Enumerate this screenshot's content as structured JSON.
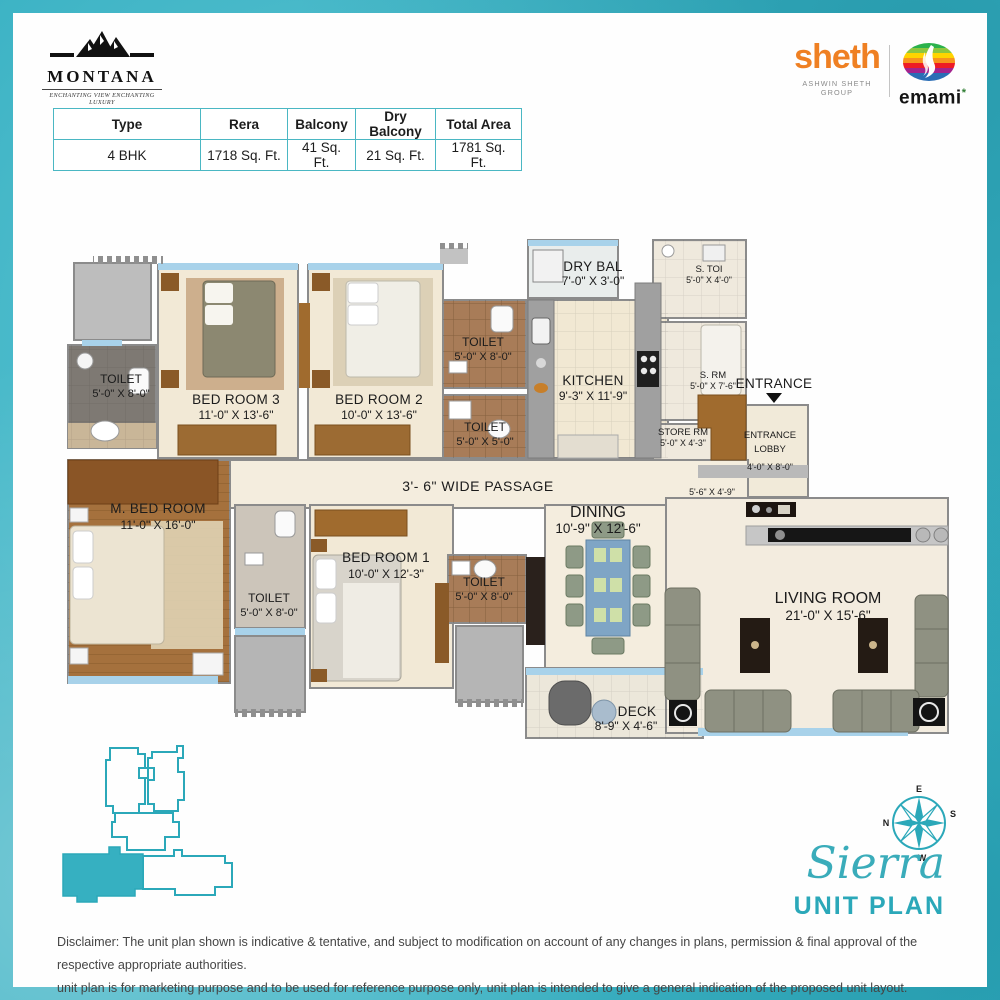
{
  "header": {
    "montana": {
      "name": "MONTANA",
      "tagline": "ENCHANTING VIEW ENCHANTING LUXURY"
    },
    "sheth": {
      "name": "sheth",
      "subtitle": "ASHWIN SHETH GROUP",
      "color": "#ef8023"
    },
    "emami": {
      "name": "emami",
      "mark": "*"
    }
  },
  "spec_table": {
    "headers": [
      "Type",
      "Rera",
      "Balcony",
      "Dry Balcony",
      "Total Area"
    ],
    "row": [
      "4 BHK",
      "1718 Sq. Ft.",
      "41 Sq. Ft.",
      "21 Sq. Ft.",
      "1781 Sq. Ft."
    ]
  },
  "plan": {
    "passage_label": "3'- 6\" WIDE PASSAGE",
    "entrance_label": "ENTRANCE",
    "lobby": {
      "line1": "ENTRANCE",
      "line2": "LOBBY",
      "dims": "4'-0\" X 8'-0\""
    },
    "lobby_passage_dims": "5'-6\" X 4'-9\"",
    "rooms": [
      {
        "name": "TOILET",
        "dims": "5'-0\" X 8'-0\""
      },
      {
        "name": "BED ROOM 3",
        "dims": "11'-0\" X 13'-6\""
      },
      {
        "name": "BED ROOM 2",
        "dims": "10'-0\" X 13'-6\""
      },
      {
        "name": "TOILET",
        "dims": "5'-0\" X 8'-0\""
      },
      {
        "name": "TOILET",
        "dims": "5'-0\" X 5'-0\""
      },
      {
        "name": "DRY BAL",
        "dims": "7'-0\" X 3'-0\""
      },
      {
        "name": "KITCHEN",
        "dims": "9'-3\" X 11'-9\""
      },
      {
        "name": "S. TOI",
        "dims": "5'-0\" X 4'-0\""
      },
      {
        "name": "S. RM",
        "dims": "5'-0\" X 7'-6\""
      },
      {
        "name": "STORE RM",
        "dims": "5'-0\" X 4'-3\""
      },
      {
        "name": "M. BED ROOM",
        "dims": "11'-0\" X 16'-0\""
      },
      {
        "name": "TOILET",
        "dims": "5'-0\" X 8'-0\""
      },
      {
        "name": "BED ROOM 1",
        "dims": "10'-0\" X 12'-3\""
      },
      {
        "name": "TOILET",
        "dims": "5'-0\" X 8'-0\""
      },
      {
        "name": "DINING",
        "dims": "10'-9\" X 12'-6\""
      },
      {
        "name": "DECK",
        "dims": "8'-9\" X 4'-6\""
      },
      {
        "name": "LIVING ROOM",
        "dims": "21'-0\" X 15'-6\""
      }
    ]
  },
  "branding": {
    "project_name": "Sierra",
    "plan_type": "UNIT PLAN",
    "compass": {
      "n": "N",
      "e": "E",
      "s": "S",
      "w": "W"
    },
    "accent_teal": "#2ba8b9"
  },
  "disclaimer": {
    "line1": "Disclaimer: The unit plan shown is indicative & tentative, and subject to modification on account of any changes in plans, permission & final approval of the respective appropriate authorities.",
    "line2": "unit plan is for marketing purpose and to be used for reference purpose only, unit plan is intended to give a general indication of the proposed unit layout."
  }
}
